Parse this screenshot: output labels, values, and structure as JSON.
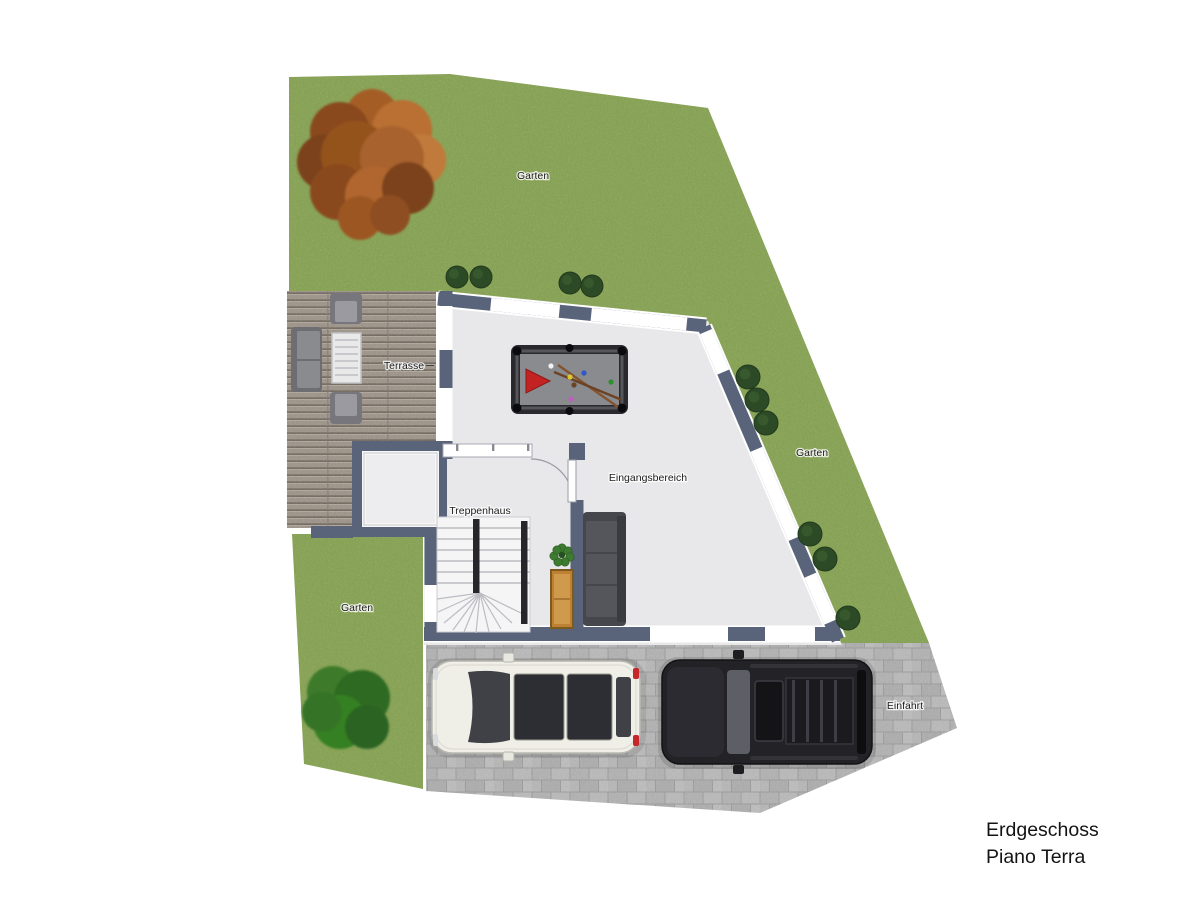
{
  "title": {
    "line1": "Erdgeschoss",
    "line2": "Piano Terra"
  },
  "labels": {
    "garden_top": "Garten",
    "garden_right": "Garten",
    "garden_left": "Garten",
    "terrace": "Terrasse",
    "entrance": "Eingangsbereich",
    "staircase": "Treppenhaus",
    "driveway": "Einfahrt"
  },
  "colors": {
    "grass": "#83a14d",
    "wall": "#59637a",
    "interior": "#e8e8ea",
    "deck": "#9c9287",
    "pavement": "#b4b4b4",
    "pool_felt": "#898b8f",
    "pool_triangle_red": "#c32222",
    "autumn_tree": "#a8622d",
    "bush_green": "#2d4a26",
    "white_car": "#efeee7",
    "black_car": "#222227"
  }
}
